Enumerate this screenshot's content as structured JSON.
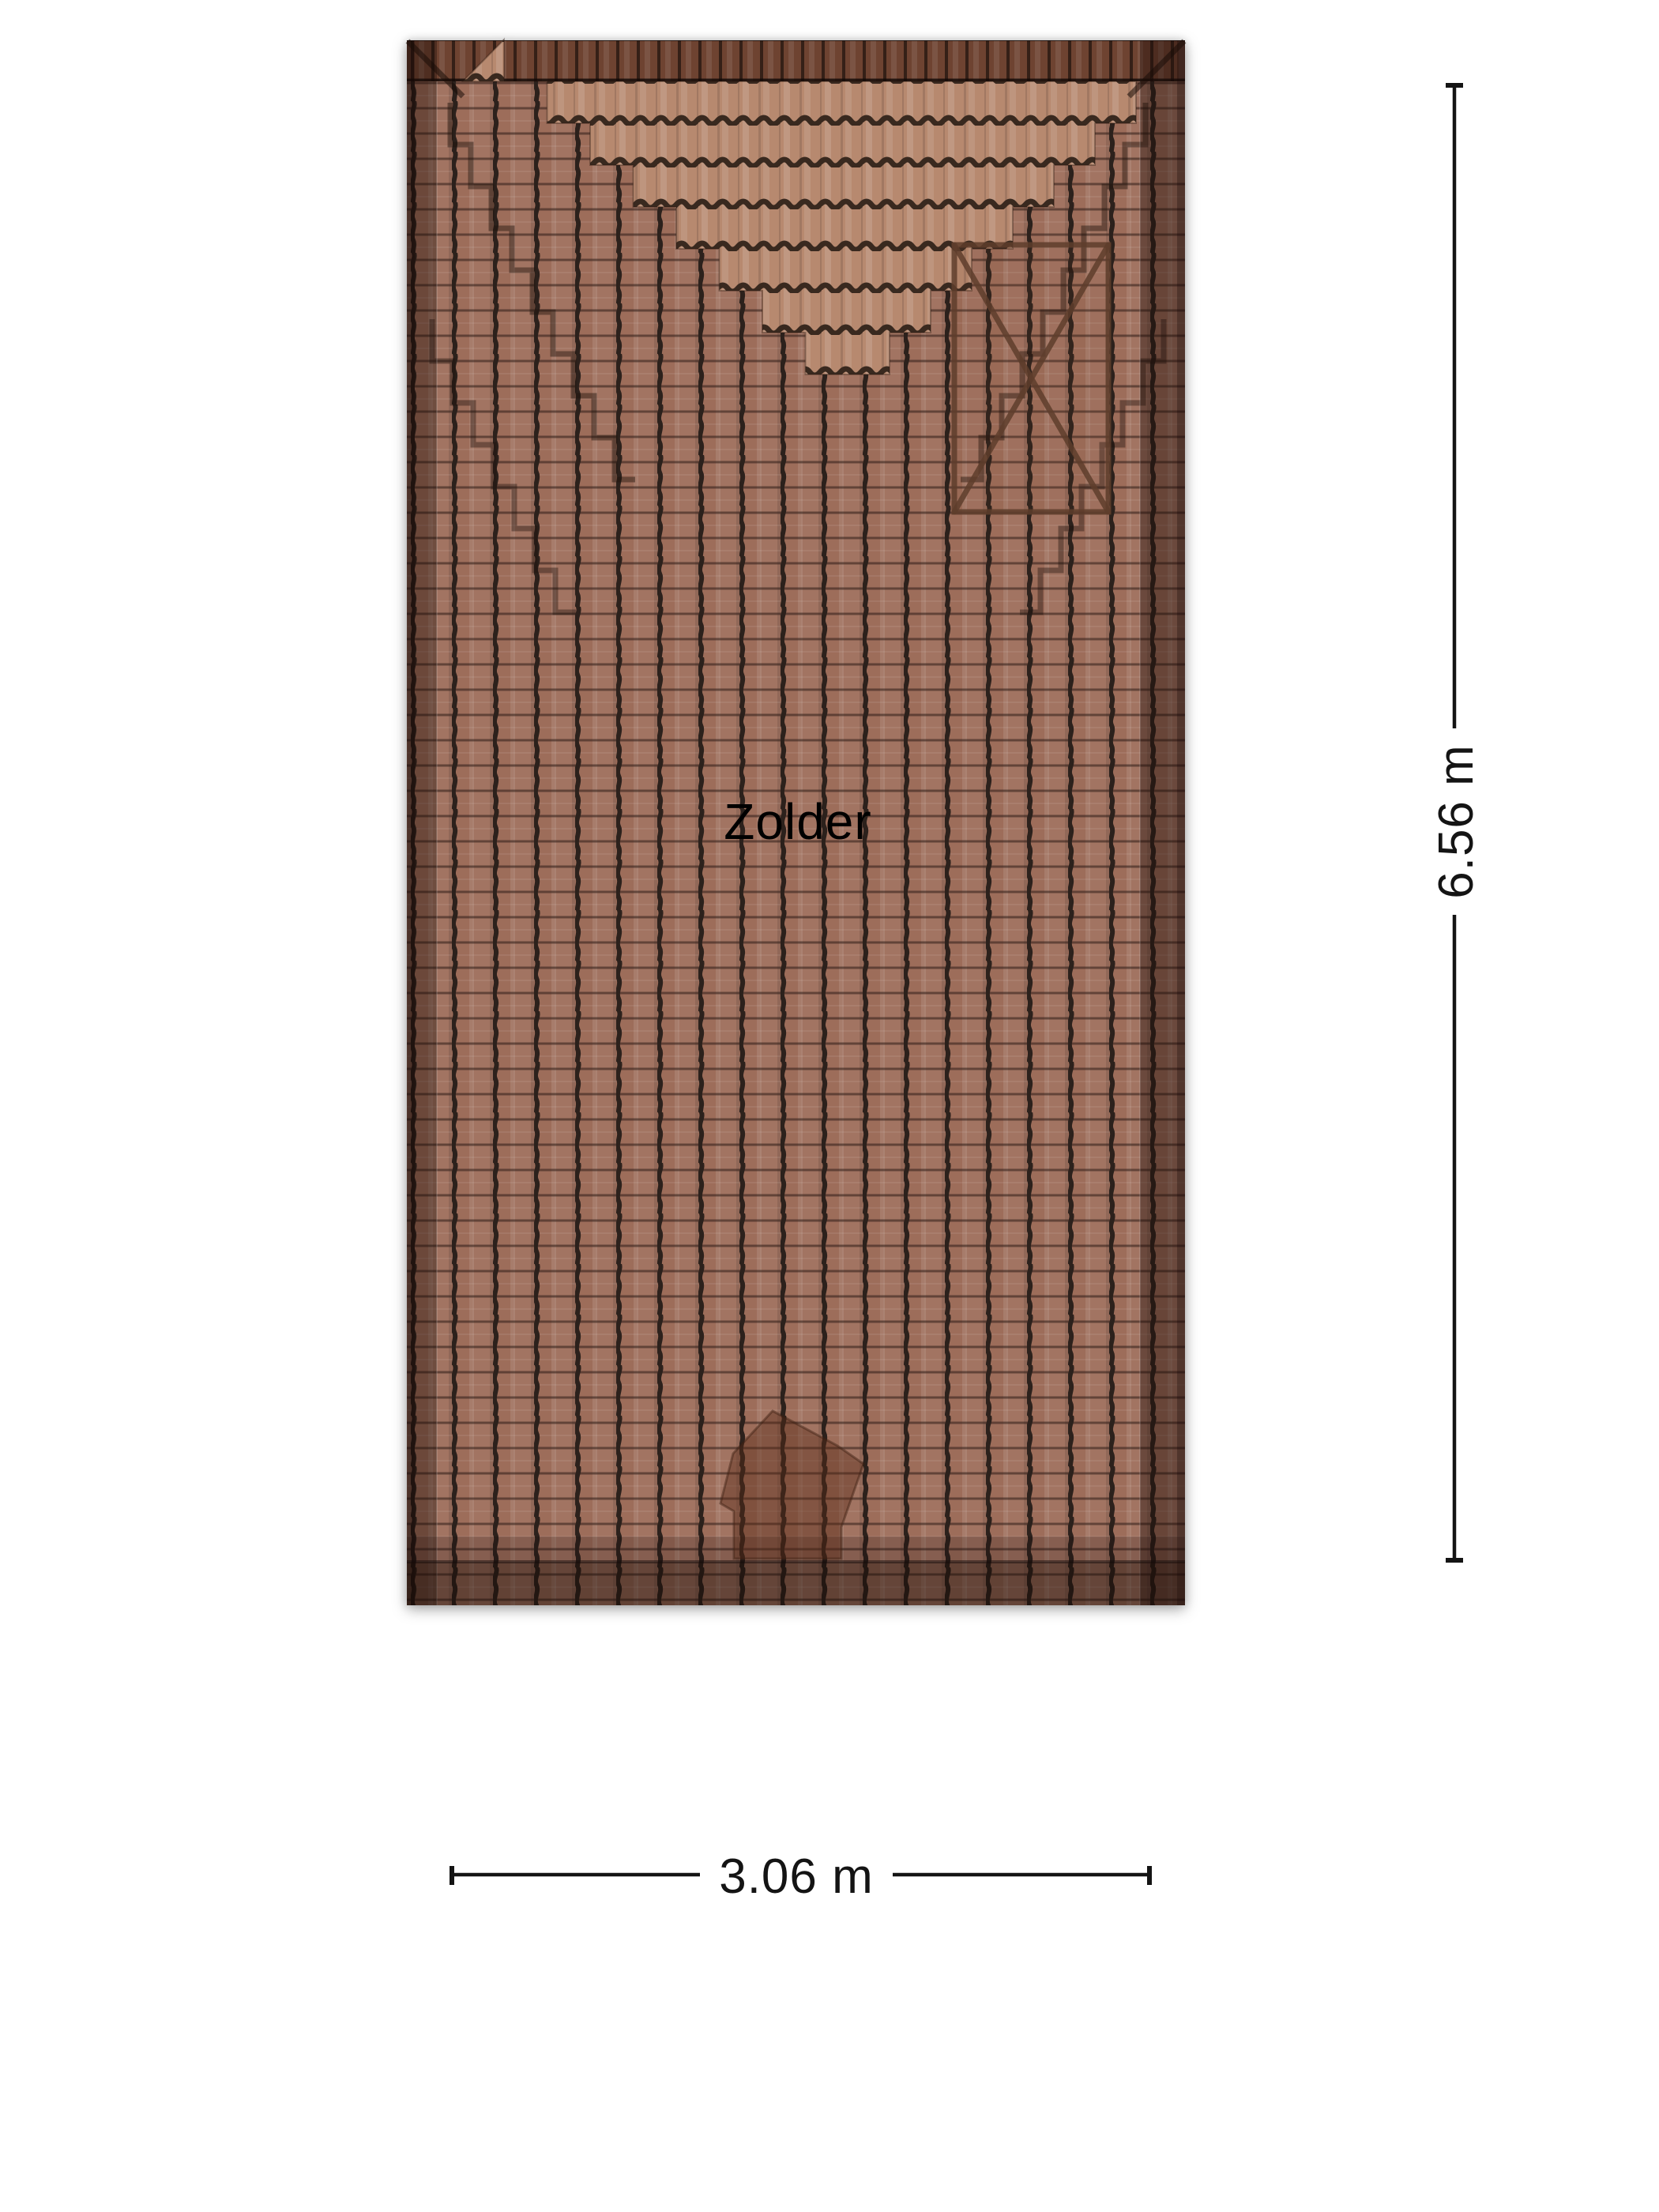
{
  "plan": {
    "room_label": "Zolder",
    "texture": "roof-tiles",
    "features": {
      "void_marker": "crossed rectangle opening (top right)",
      "chimney_shadow": "dark translucent polygon near bottom center"
    }
  },
  "dimensions": {
    "height": "6.56 m",
    "width": "3.06 m"
  },
  "colors": {
    "background": "#ffffff",
    "tile_base": "#9d6d5a",
    "tile_light": "#b7896f",
    "tile_ridge": "#6e4331",
    "tile_gap": "#2c211c",
    "void_marker_stroke": "#5e3d2c",
    "dimension_ink": "#141414",
    "label_ink": "#000000"
  }
}
